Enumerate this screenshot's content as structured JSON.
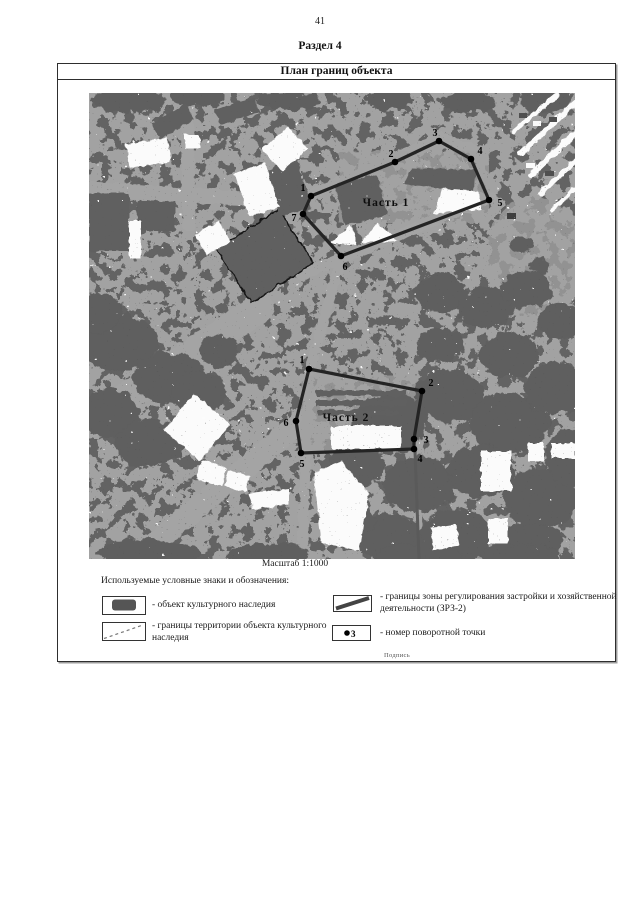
{
  "page": {
    "number": "41",
    "section_title": "Раздел 4"
  },
  "plan": {
    "title": "План границ объекта",
    "scale_label": "Масштаб 1:1000",
    "footer_note": "Подпись"
  },
  "legend": {
    "header": "Используемые условные знаки и обозначения:",
    "items": [
      {
        "symbol": "heritage-object",
        "text": "- объект культурного наследия"
      },
      {
        "symbol": "zrz-boundary",
        "text": "- границы зоны регулирования застройки и хозяйственной деятельности (ЗРЗ-2)"
      },
      {
        "symbol": "territory-boundary",
        "text": "- границы территории объекта культурного наследия"
      },
      {
        "symbol": "turn-point",
        "symbol_label": "3",
        "text": "- номер поворотной точки"
      }
    ]
  },
  "map": {
    "base_color": "#a2a2a2",
    "dark_color": "#646464",
    "white_color": "#fbfbfb",
    "boundary_color": "#242424",
    "parts": [
      {
        "label": "Часть 1",
        "label_x": 297,
        "label_y": 113,
        "points": [
          {
            "label": "1",
            "x": 222,
            "y": 103,
            "lx": 214,
            "ly": 98
          },
          {
            "label": "2",
            "x": 306,
            "y": 69,
            "lx": 302,
            "ly": 64
          },
          {
            "label": "3",
            "x": 350,
            "y": 48,
            "lx": 346,
            "ly": 43
          },
          {
            "label": "4",
            "x": 382,
            "y": 66,
            "lx": 391,
            "ly": 61
          },
          {
            "label": "5",
            "x": 400,
            "y": 107,
            "lx": 411,
            "ly": 113
          },
          {
            "label": "6",
            "x": 252,
            "y": 163,
            "lx": 256,
            "ly": 177
          },
          {
            "label": "7",
            "x": 214,
            "y": 121,
            "lx": 205,
            "ly": 128
          }
        ]
      },
      {
        "label": "Часть 2",
        "label_x": 257,
        "label_y": 328,
        "points": [
          {
            "label": "1",
            "x": 220,
            "y": 276,
            "lx": 213,
            "ly": 270
          },
          {
            "label": "2",
            "x": 333,
            "y": 298,
            "lx": 342,
            "ly": 293
          },
          {
            "label": "3",
            "x": 325,
            "y": 346,
            "lx": 337,
            "ly": 350
          },
          {
            "label": "4",
            "x": 325,
            "y": 356,
            "lx": 331,
            "ly": 369
          },
          {
            "label": "5",
            "x": 212,
            "y": 360,
            "lx": 213,
            "ly": 374
          },
          {
            "label": "6",
            "x": 207,
            "y": 328,
            "lx": 197,
            "ly": 333
          }
        ]
      }
    ]
  }
}
